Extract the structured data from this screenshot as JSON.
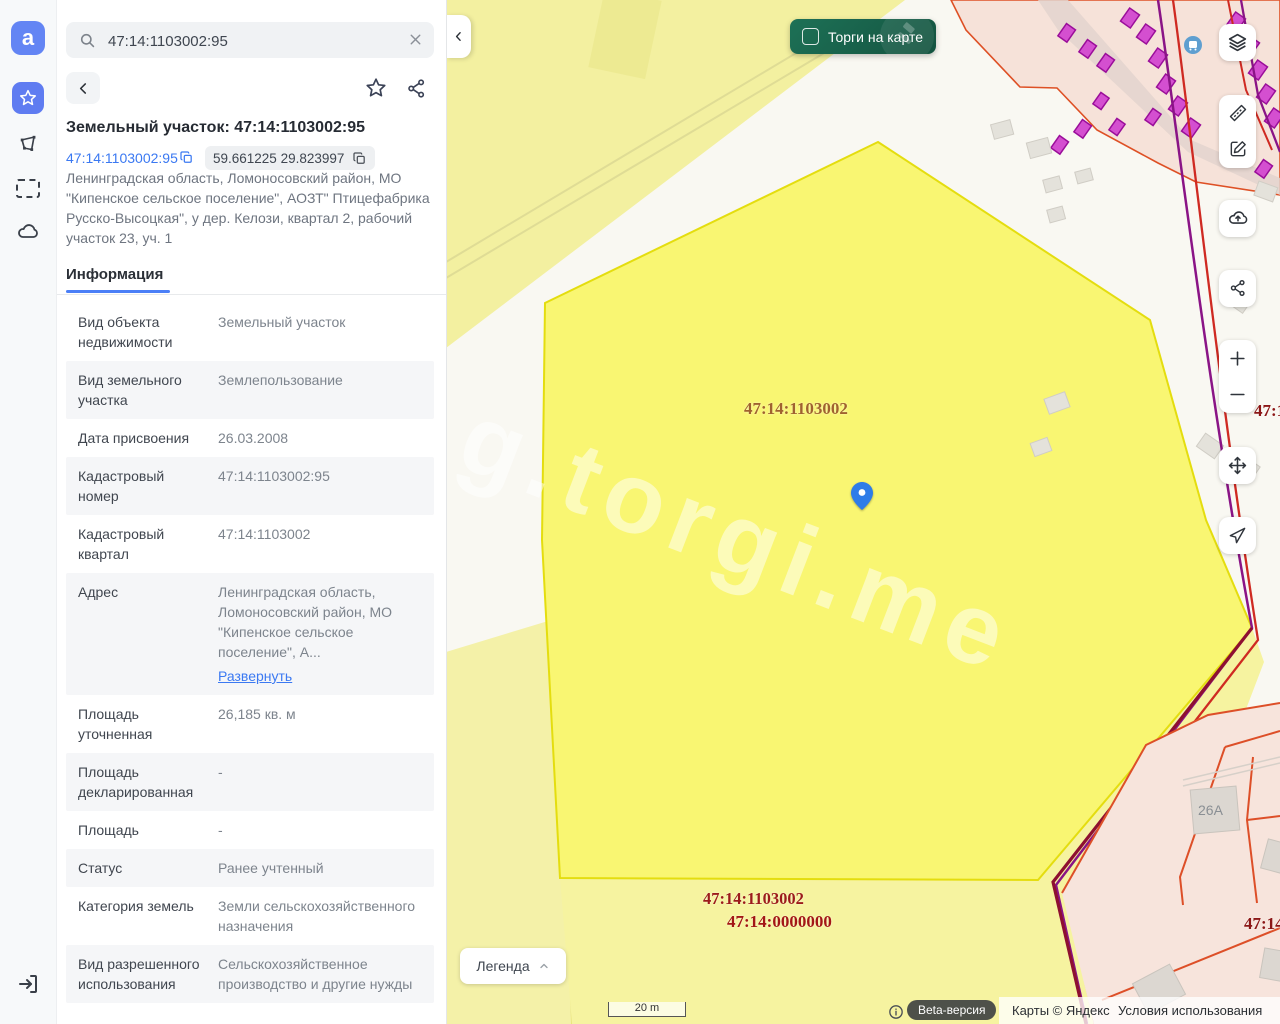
{
  "rail": {
    "logo_letter": "a"
  },
  "sidebar": {
    "search": {
      "value": "47:14:1103002:95"
    },
    "title": "Земельный участок: 47:14:1103002:95",
    "cadastral_link": "47:14:1103002:95",
    "coords_chip": "59.661225 29.823997",
    "address_full": "Ленинградская область, Ломоносовский район, МО \"Кипенское сельское поселение\", АОЗТ\" Птицефабрика Русско-Высоцкая\", у дер. Келози, квартал 2, рабочий участок 23, уч. 1",
    "tab": "Информация",
    "rows": [
      {
        "label": "Вид объекта недвижимости",
        "value": "Земельный участок"
      },
      {
        "label": "Вид земельного участка",
        "value": "Землепользование"
      },
      {
        "label": "Дата присвоения",
        "value": "26.03.2008"
      },
      {
        "label": "Кадастровый номер",
        "value": "47:14:1103002:95"
      },
      {
        "label": "Кадастровый квартал",
        "value": "47:14:1103002"
      },
      {
        "label": "Адрес",
        "value": "Ленинградская область, Ломоносовский район, МО \"Кипенское сельское поселение\", А...",
        "link": "Развернуть"
      },
      {
        "label": "Площадь уточненная",
        "value": "26,185 кв. м"
      },
      {
        "label": "Площадь декларированная",
        "value": "-"
      },
      {
        "label": "Площадь",
        "value": "-"
      },
      {
        "label": "Статус",
        "value": "Ранее учтенный"
      },
      {
        "label": "Категория земель",
        "value": "Земли сельскохозяйственного назначения"
      },
      {
        "label": "Вид разрешенного использования",
        "value": "Сельскохозяйственное производство и другие нужды"
      }
    ]
  },
  "map": {
    "toggle_label": "Торги на карте",
    "legend_label": "Легенда",
    "scale_label": "20 m",
    "watermark": "g.torgi.me",
    "labels": {
      "quarter_center": "47:14:1103002",
      "quarter_bottom": "47:14:1103002",
      "district_bottom": "47:14:0000000",
      "edge_right_top": "47:14",
      "edge_right_bottom": "47:14",
      "house": "26A"
    },
    "attribution": {
      "beta": "Beta-версия",
      "maps": "Карты © Яндекс",
      "terms": "Условия использования"
    },
    "colors": {
      "accent_blue": "#3b79f2",
      "toggle_green": "#17684e",
      "selected_parcel_yellow": "#f9f672",
      "parcel_border_yellow": "#e4dd0f",
      "pink_zone": "#f6e2d9",
      "magenta_building": "#d44fd0",
      "purple_line": "#8a1486",
      "red_line": "#cf2a22",
      "label_brown": "#a0622f",
      "label_red": "#9c1b1b"
    }
  }
}
